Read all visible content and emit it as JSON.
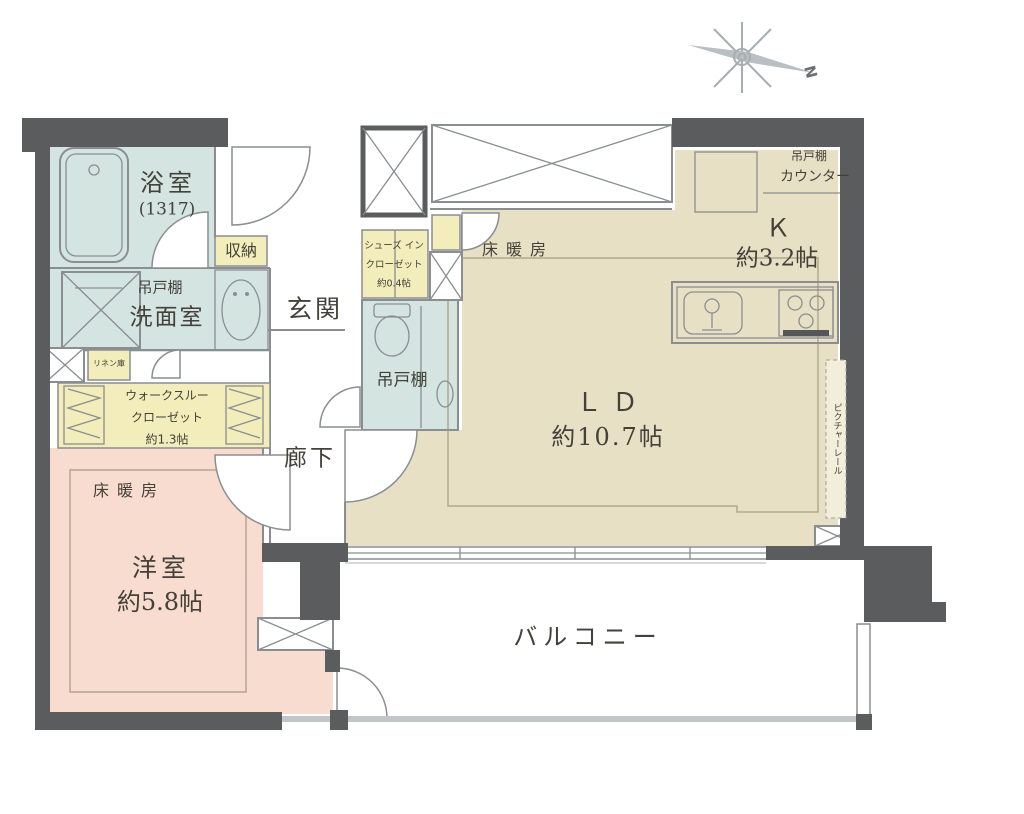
{
  "colors": {
    "wall": "#5b5c5e",
    "wet": "#d3e4e1",
    "living": "#e8e0c5",
    "bedroom": "#f9dcd0",
    "closet": "#f2edba",
    "line": "#8a8e91",
    "heat": "#b3a78d",
    "text": "#44403a",
    "compass": "#a7adb0"
  },
  "compass": {
    "north_label": "N"
  },
  "rooms": {
    "bathroom": {
      "name": "浴室",
      "size": "(1317)"
    },
    "washroom": {
      "name": "洗面室",
      "hanging_cabinet": "吊戸棚"
    },
    "hall_storage": {
      "name": "収納"
    },
    "linen_storage": {
      "name": "リネン庫"
    },
    "walk_through_closet": {
      "name_line1": "ウォークスルー",
      "name_line2": "クローゼット",
      "size": "約1.3帖"
    },
    "western_room": {
      "name": "洋室",
      "size": "約5.8帖",
      "floor_heating": "床暖房"
    },
    "entrance": {
      "name": "玄関"
    },
    "shoes_in_closet": {
      "name_line1": "シューズ イン",
      "name_line2": "クローゼット",
      "size": "約0.4帖"
    },
    "toilet": {
      "hanging_cabinet": "吊戸棚"
    },
    "hallway": {
      "name": "廊下"
    },
    "living_dining": {
      "name": "ＬＤ",
      "size": "約10.7帖",
      "floor_heating": "床暖房",
      "picture_rail": "ピクチャーレール"
    },
    "kitchen": {
      "name": "Ｋ",
      "size": "約3.2帖",
      "hanging_cabinet": "吊戸棚",
      "counter": "カウンター"
    },
    "balcony": {
      "name": "バルコニー"
    }
  }
}
